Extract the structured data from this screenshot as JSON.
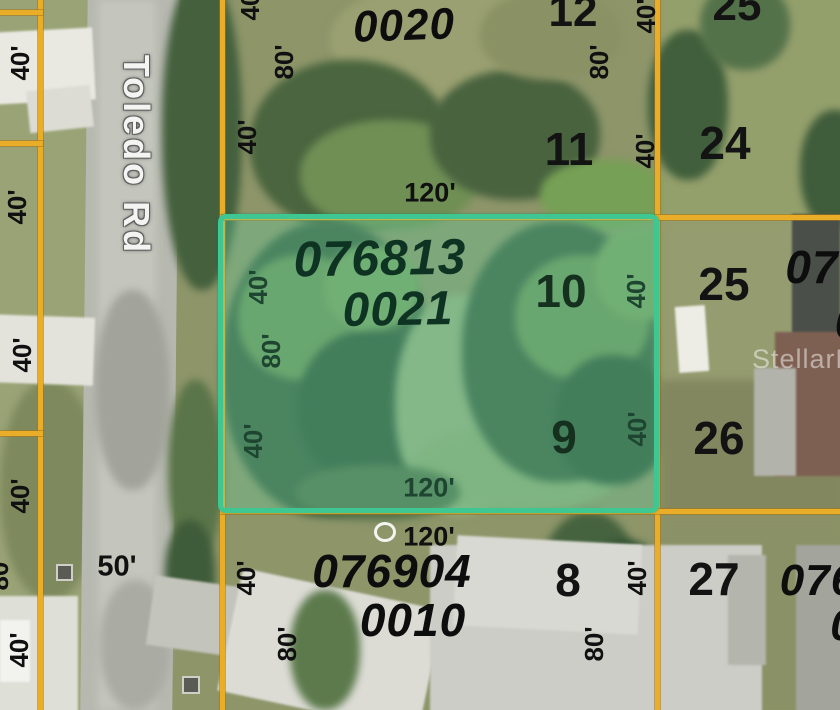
{
  "map": {
    "road_name": "Toledo Rd",
    "watermark": "StellarMLS",
    "highlighted_parcel": {
      "id": "076813 0021",
      "frontage": "120'",
      "depth": "80'",
      "lots": [
        "10",
        "9"
      ],
      "border_color": "#3ec793",
      "fill_color": "rgba(96,205,162,0.33)"
    },
    "boundary_color": "#e9ad28",
    "road_width_label": "50'"
  },
  "annotations": [
    {
      "text": "40'",
      "type": "dim",
      "x": 20,
      "y": 63,
      "rot": -90
    },
    {
      "text": "40'",
      "type": "dim",
      "x": 17,
      "y": 207,
      "rot": -90
    },
    {
      "text": "40'",
      "type": "dim",
      "x": 22,
      "y": 355,
      "rot": -90
    },
    {
      "text": "40'",
      "type": "dim",
      "x": 20,
      "y": 496,
      "rot": -90
    },
    {
      "text": "80'",
      "type": "dim",
      "x": -1,
      "y": 573,
      "rot": -90
    },
    {
      "text": "40'",
      "type": "dim",
      "x": 19,
      "y": 650,
      "rot": -90
    },
    {
      "text": "40'",
      "type": "dim",
      "x": 250,
      "y": 3,
      "rot": -90
    },
    {
      "text": "80'",
      "type": "dim",
      "x": 284,
      "y": 62,
      "rot": -90
    },
    {
      "text": "40'",
      "type": "dim",
      "x": 247,
      "y": 137,
      "rot": -90
    },
    {
      "text": "120'",
      "type": "dim",
      "x": 430,
      "y": 193,
      "rot": 0,
      "size": 27
    },
    {
      "text": "80'",
      "type": "dim",
      "x": 599,
      "y": 62,
      "rot": -90
    },
    {
      "text": "40'",
      "type": "dim",
      "x": 646,
      "y": 16,
      "rot": -90
    },
    {
      "text": "40'",
      "type": "dim",
      "x": 645,
      "y": 151,
      "rot": -90
    },
    {
      "text": "40'",
      "type": "dim",
      "x": 258,
      "y": 287,
      "rot": -90,
      "inside": true
    },
    {
      "text": "80'",
      "type": "dim",
      "x": 271,
      "y": 351,
      "rot": -90,
      "inside": true
    },
    {
      "text": "40'",
      "type": "dim",
      "x": 253,
      "y": 441,
      "rot": -90,
      "inside": true
    },
    {
      "text": "40'",
      "type": "dim",
      "x": 636,
      "y": 291,
      "rot": -90,
      "inside": true
    },
    {
      "text": "40'",
      "type": "dim",
      "x": 637,
      "y": 429,
      "rot": -90,
      "inside": true
    },
    {
      "text": "120'",
      "type": "dim",
      "x": 429,
      "y": 488,
      "rot": 0,
      "size": 27,
      "inside": true
    },
    {
      "text": "120'",
      "type": "dim",
      "x": 429,
      "y": 537,
      "rot": 0,
      "size": 27
    },
    {
      "text": "50'",
      "type": "dim",
      "x": 117,
      "y": 567,
      "rot": 0,
      "size": 29
    },
    {
      "text": "40'",
      "type": "dim",
      "x": 246,
      "y": 578,
      "rot": -90
    },
    {
      "text": "80'",
      "type": "dim",
      "x": 287,
      "y": 644,
      "rot": -90
    },
    {
      "text": "80'",
      "type": "dim",
      "x": 594,
      "y": 644,
      "rot": -90
    },
    {
      "text": "40'",
      "type": "dim",
      "x": 637,
      "y": 578,
      "rot": -90
    },
    {
      "text": "12",
      "type": "lot",
      "x": 573,
      "y": 12,
      "size": 44
    },
    {
      "text": "25",
      "type": "lot",
      "x": 737,
      "y": 6,
      "size": 44
    },
    {
      "text": "11",
      "type": "lot",
      "x": 569,
      "y": 149
    },
    {
      "text": "24",
      "type": "lot",
      "x": 725,
      "y": 143
    },
    {
      "text": "10",
      "type": "lot",
      "x": 561,
      "y": 291,
      "inside": true
    },
    {
      "text": "25",
      "type": "lot",
      "x": 724,
      "y": 284
    },
    {
      "text": "9",
      "type": "lot",
      "x": 564,
      "y": 437,
      "inside": true
    },
    {
      "text": "26",
      "type": "lot",
      "x": 719,
      "y": 438
    },
    {
      "text": "8",
      "type": "lot",
      "x": 568,
      "y": 580
    },
    {
      "text": "27",
      "type": "lot",
      "x": 714,
      "y": 579
    },
    {
      "text": "0020",
      "type": "pid",
      "x": 404,
      "y": 26,
      "rot": -2,
      "size": 44
    },
    {
      "text": "076813",
      "type": "pid",
      "x": 380,
      "y": 258,
      "rot": -1,
      "size": 50,
      "inside": true
    },
    {
      "text": "0021",
      "type": "pid",
      "x": 398,
      "y": 310,
      "rot": -1,
      "size": 48,
      "inside": true
    },
    {
      "text": "07",
      "type": "pid",
      "x": 812,
      "y": 267,
      "size": 46
    },
    {
      "text": "0",
      "type": "pid",
      "x": 848,
      "y": 322,
      "size": 46
    },
    {
      "text": "076904",
      "type": "pid",
      "x": 392,
      "y": 571,
      "size": 46
    },
    {
      "text": "0010",
      "type": "pid",
      "x": 413,
      "y": 620,
      "size": 46
    },
    {
      "text": "076",
      "type": "pid",
      "x": 818,
      "y": 581,
      "size": 44
    },
    {
      "text": "0",
      "type": "pid",
      "x": 843,
      "y": 626,
      "size": 44
    }
  ]
}
